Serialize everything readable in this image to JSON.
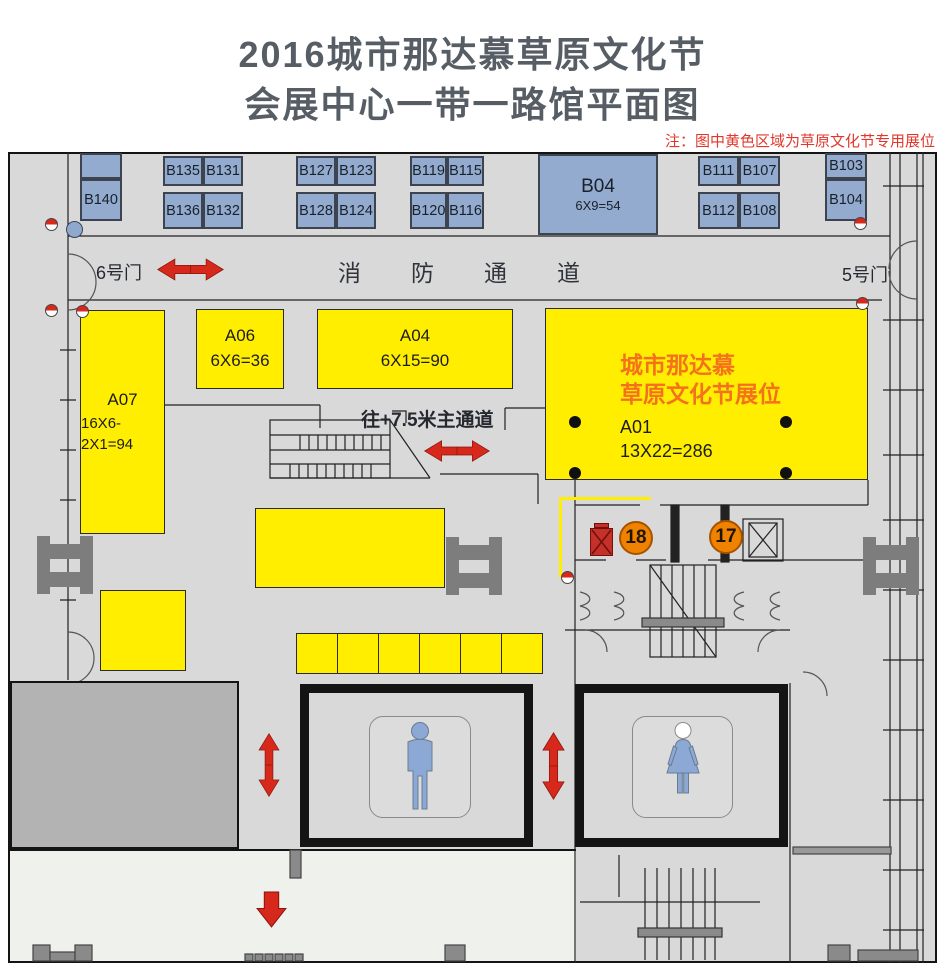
{
  "title": {
    "line1": "2016城市那达慕草原文化节",
    "line2": "会展中心一带一路馆平面图"
  },
  "note": "注：图中黄色区域为草原文化节专用展位",
  "fire_lane": {
    "label": "消防通道",
    "gate_left": "6号门",
    "gate_right": "5号门"
  },
  "corridor": {
    "label": "往+7.5米主通道"
  },
  "blue_booths": {
    "b140": "B140",
    "b135": "B135",
    "b131": "B131",
    "b136": "B136",
    "b132": "B132",
    "b127": "B127",
    "b123": "B123",
    "b128": "B128",
    "b124": "B124",
    "b119": "B119",
    "b115": "B115",
    "b120": "B120",
    "b116": "B116",
    "b04": {
      "id": "B04",
      "size": "6X9=54"
    },
    "b111": "B111",
    "b107": "B107",
    "b112": "B112",
    "b108": "B108",
    "b103": "B103",
    "b104": "B104"
  },
  "yellow_booths": {
    "a07": {
      "id": "A07",
      "size": "16X6-2X1=94"
    },
    "a06": {
      "id": "A06",
      "size": "6X6=36"
    },
    "a04": {
      "id": "A04",
      "size": "6X15=90"
    },
    "a01": {
      "id": "A01",
      "size": "13X22=286",
      "title1": "城市那达慕",
      "title2": "草原文化节展位"
    }
  },
  "markers": {
    "m18": "18",
    "m17": "17"
  },
  "icons": {
    "fire_hydrant": "red-white half circle",
    "male_restroom": "male-figure",
    "female_restroom": "female-figure",
    "direction_arrows": "red double/single arrows"
  },
  "colors": {
    "title_gray": "#575d64",
    "note_red": "#e0372a",
    "booth_blue": "#92abce",
    "booth_yellow": "#ffee00",
    "highlight_orange": "#f4711d",
    "marker_orange": "#ef8200",
    "arrow_red": "#d7281c",
    "hall_gray": "#d9d9d9"
  }
}
